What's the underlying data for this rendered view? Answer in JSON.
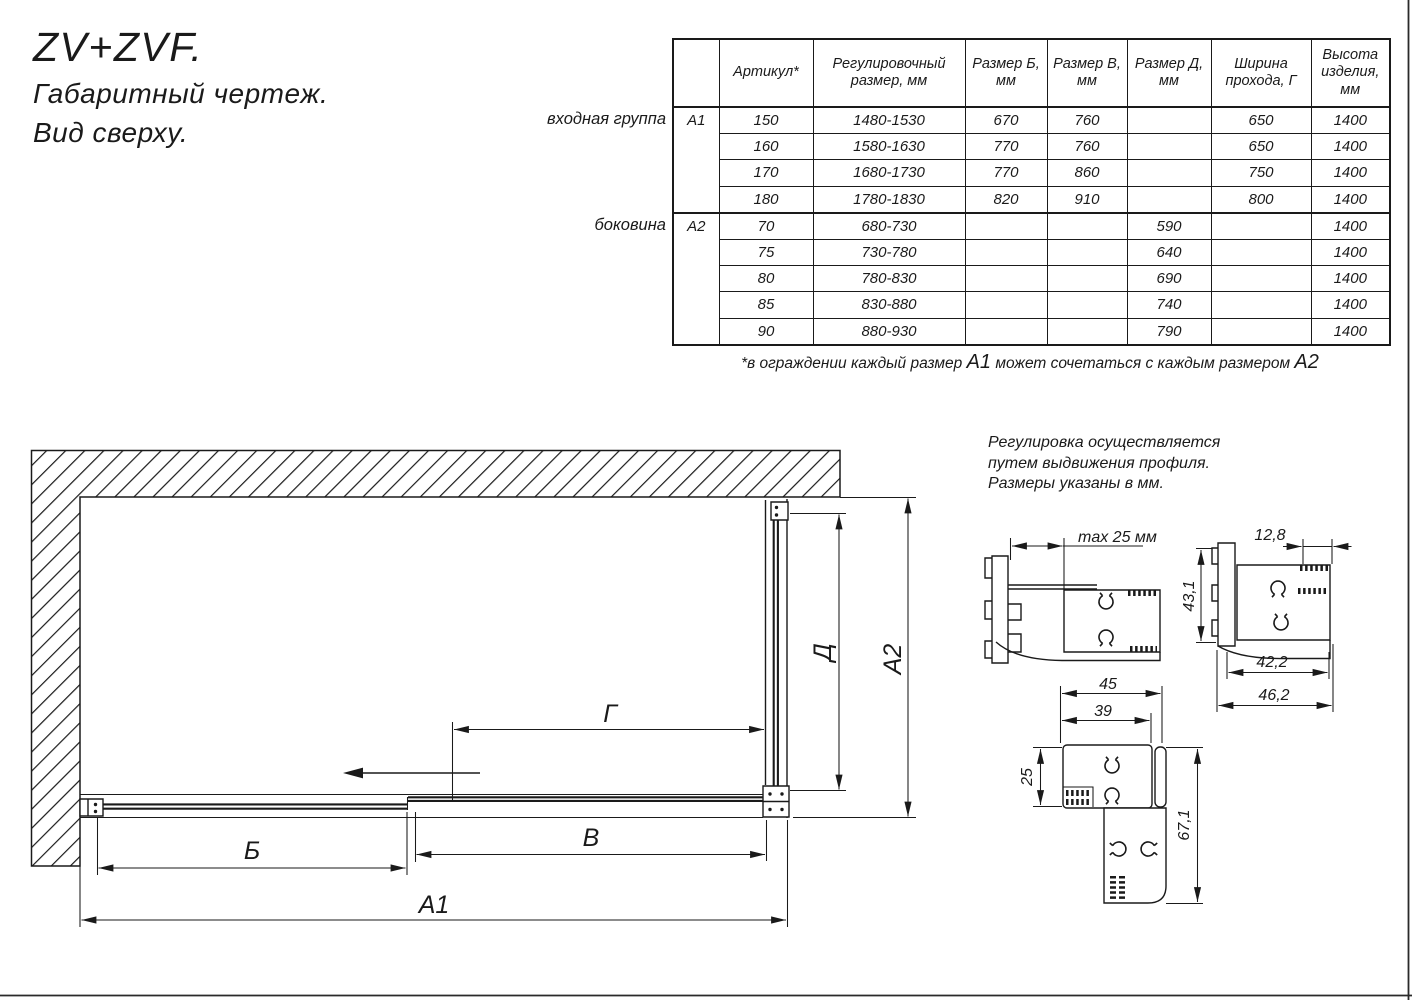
{
  "header": {
    "title": "ZV+ZVF.",
    "subtitle1": "Габаритный чертеж.",
    "subtitle2": "Вид сверху."
  },
  "table": {
    "headers": [
      "",
      "Артикул*",
      "Регулировочный размер, мм",
      "Размер Б, мм",
      "Размер В, мм",
      "Размер Д, мм",
      "Ширина прохода, Г",
      "Высота изделия, мм"
    ],
    "groups": [
      {
        "side_label": "входная группа",
        "code": "А1",
        "rows": [
          [
            "150",
            "1480-1530",
            "670",
            "760",
            "",
            "650",
            "1400"
          ],
          [
            "160",
            "1580-1630",
            "770",
            "760",
            "",
            "650",
            "1400"
          ],
          [
            "170",
            "1680-1730",
            "770",
            "860",
            "",
            "750",
            "1400"
          ],
          [
            "180",
            "1780-1830",
            "820",
            "910",
            "",
            "800",
            "1400"
          ]
        ]
      },
      {
        "side_label": "боковина",
        "code": "А2",
        "rows": [
          [
            "70",
            "680-730",
            "",
            "",
            "590",
            "",
            "1400"
          ],
          [
            "75",
            "730-780",
            "",
            "",
            "640",
            "",
            "1400"
          ],
          [
            "80",
            "780-830",
            "",
            "",
            "690",
            "",
            "1400"
          ],
          [
            "85",
            "830-880",
            "",
            "",
            "740",
            "",
            "1400"
          ],
          [
            "90",
            "880-930",
            "",
            "",
            "790",
            "",
            "1400"
          ]
        ]
      }
    ],
    "footnote": {
      "part1": "*в ограждении каждый размер ",
      "em1": "А1",
      "part2": " может сочетаться с каждым размером ",
      "em2": "А2"
    }
  },
  "note": {
    "line1": "Регулировка осуществляется",
    "line2": "путем выдвижения профиля.",
    "line3": "Размеры указаны в мм."
  },
  "dims": {
    "b": "Б",
    "v": "В",
    "g": "Г",
    "d": "Д",
    "a1": "А1",
    "a2": "А2"
  },
  "details": {
    "max25": "max 25 мм",
    "w128": "12,8",
    "h431": "43,1",
    "w422": "42,2",
    "w462": "46,2",
    "w45": "45",
    "w39": "39",
    "h25": "25",
    "h671": "67,1"
  },
  "colors": {
    "line": "#1a1a1a"
  }
}
